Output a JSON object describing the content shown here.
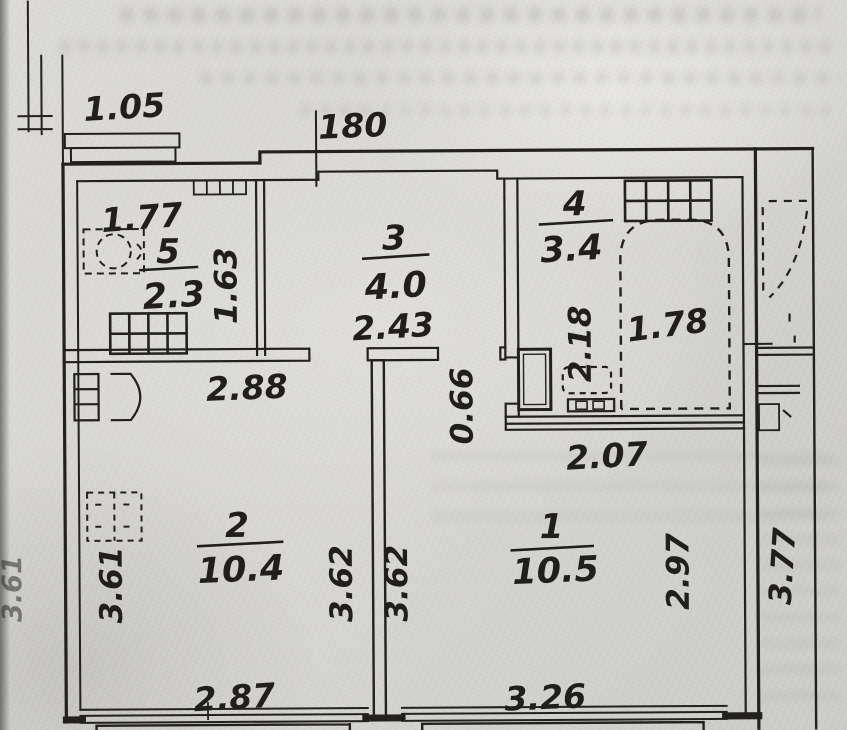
{
  "plan": {
    "title": "apartment-floor-plan",
    "rooms": [
      {
        "number": "1",
        "area": "10.5"
      },
      {
        "number": "2",
        "area": "10.4"
      },
      {
        "number": "3",
        "area": "4.0"
      },
      {
        "number": "4",
        "area": "3.4"
      },
      {
        "number": "5",
        "area": "2.3"
      }
    ],
    "dimensions": {
      "ledge_width": "1.05",
      "top_opening": "180",
      "room5_width": "1.77",
      "room5_depth": "1.63",
      "hall_width": "2.43",
      "bath_depth": "2.18",
      "bath_inner_width": "1.78",
      "bath_width": "2.07",
      "step_depth": "0.66",
      "room2_width_top": "2.88",
      "room2_depth_left": "3.61",
      "outer_left_depth": "3.61",
      "room2_depth_right": "3.62",
      "room1_depth_left": "3.62",
      "room1_depth_right": "2.97",
      "outer_right_depth": "3.77",
      "room2_window_width": "2.87",
      "room1_window_width": "3.26"
    },
    "colors": {
      "ink": "#201f1c",
      "paper": "#d8d7d3"
    }
  }
}
